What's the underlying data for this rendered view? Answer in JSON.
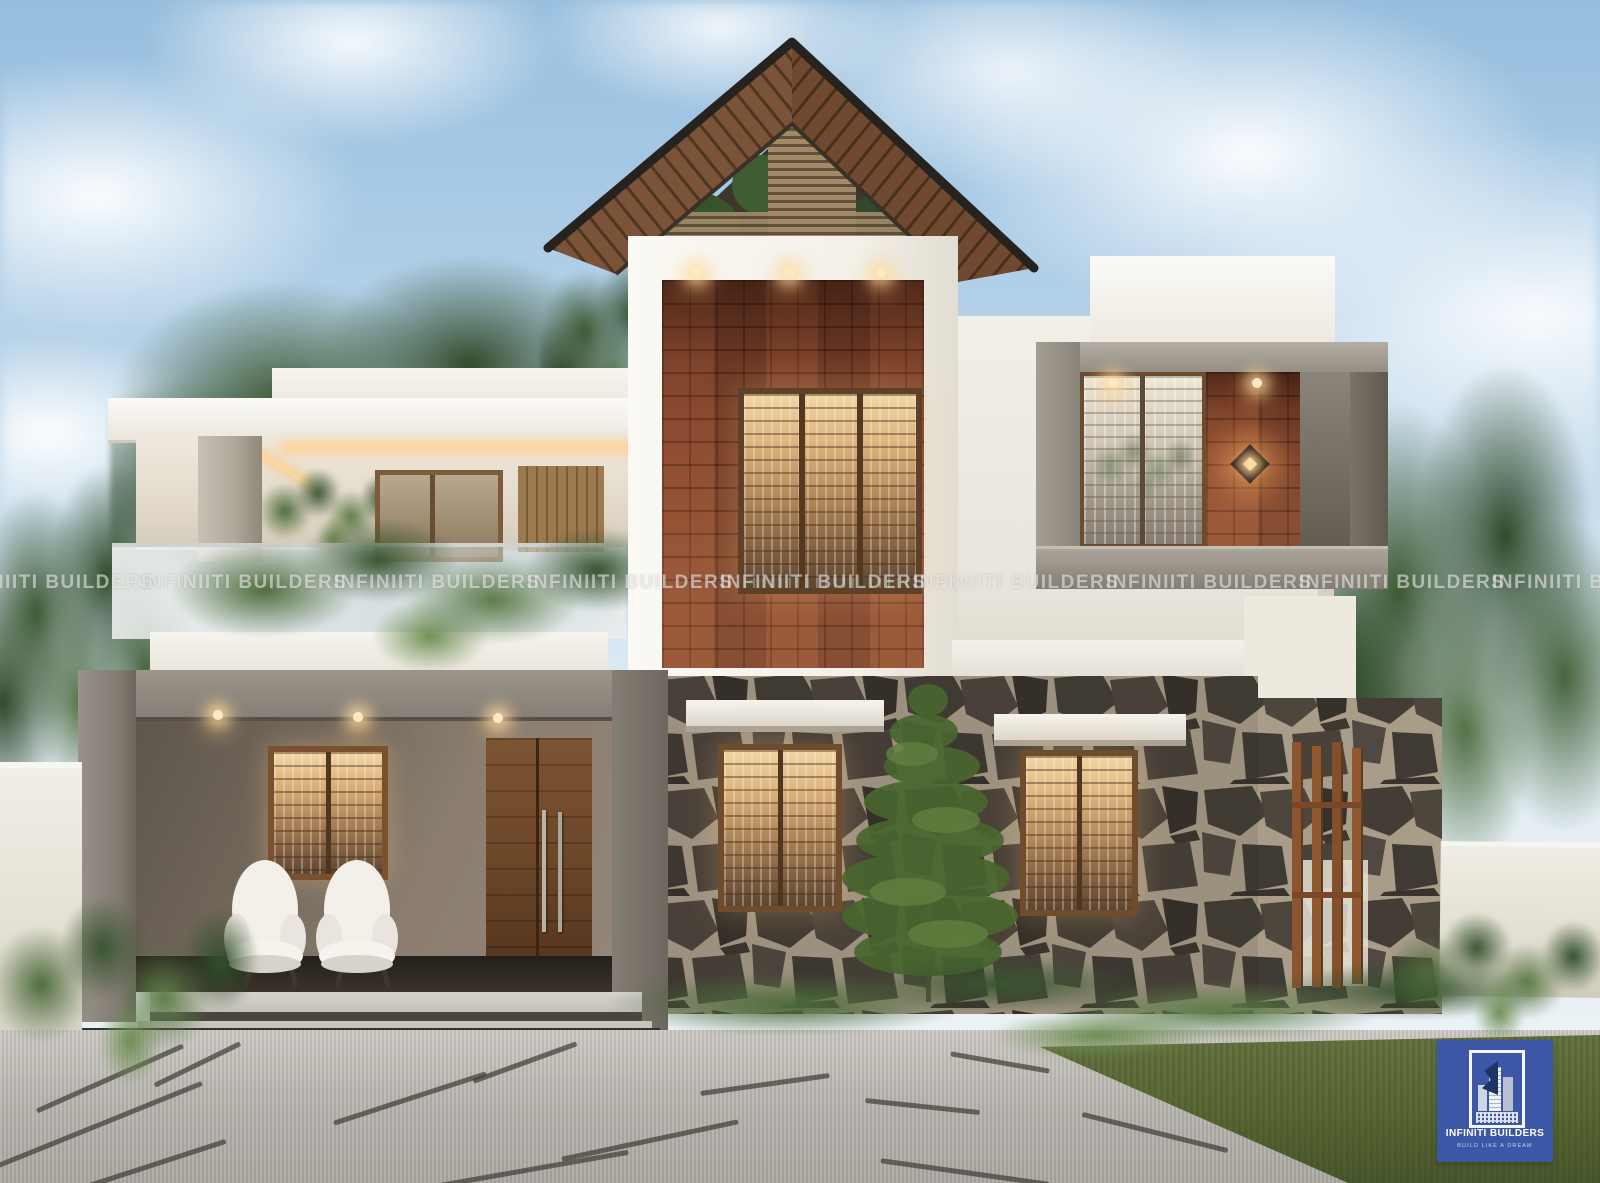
{
  "scene": {
    "type": "3D exterior architectural rendering",
    "subject": "Modern two-storey residence with steep gable roof, brick feature tower, stone-clad ground floor, glass balcony and paved driveway",
    "time_of_day": "daytime",
    "palette": {
      "sky_blue": "#a9cbe6",
      "cloud_white": "#f6f9fc",
      "wall_white": "#f2efe8",
      "concrete_grey": "#8f8a81",
      "brick_red": "#87482f",
      "roof_wood": "#7b5338",
      "stone_dark": "#45403a",
      "window_wood": "#7a5432",
      "warm_light": "#f0c98e",
      "foliage_green": "#3b5730",
      "driveway_grey": "#b3b0aa",
      "lawn_green": "#5a6b3a",
      "logo_blue": "#3b57a6"
    }
  },
  "watermark": {
    "text": "INFINIITI BUILDERS"
  },
  "logo": {
    "title": "INFINITI BUILDERS",
    "tagline": "BUILD LIKE A DREAM"
  }
}
